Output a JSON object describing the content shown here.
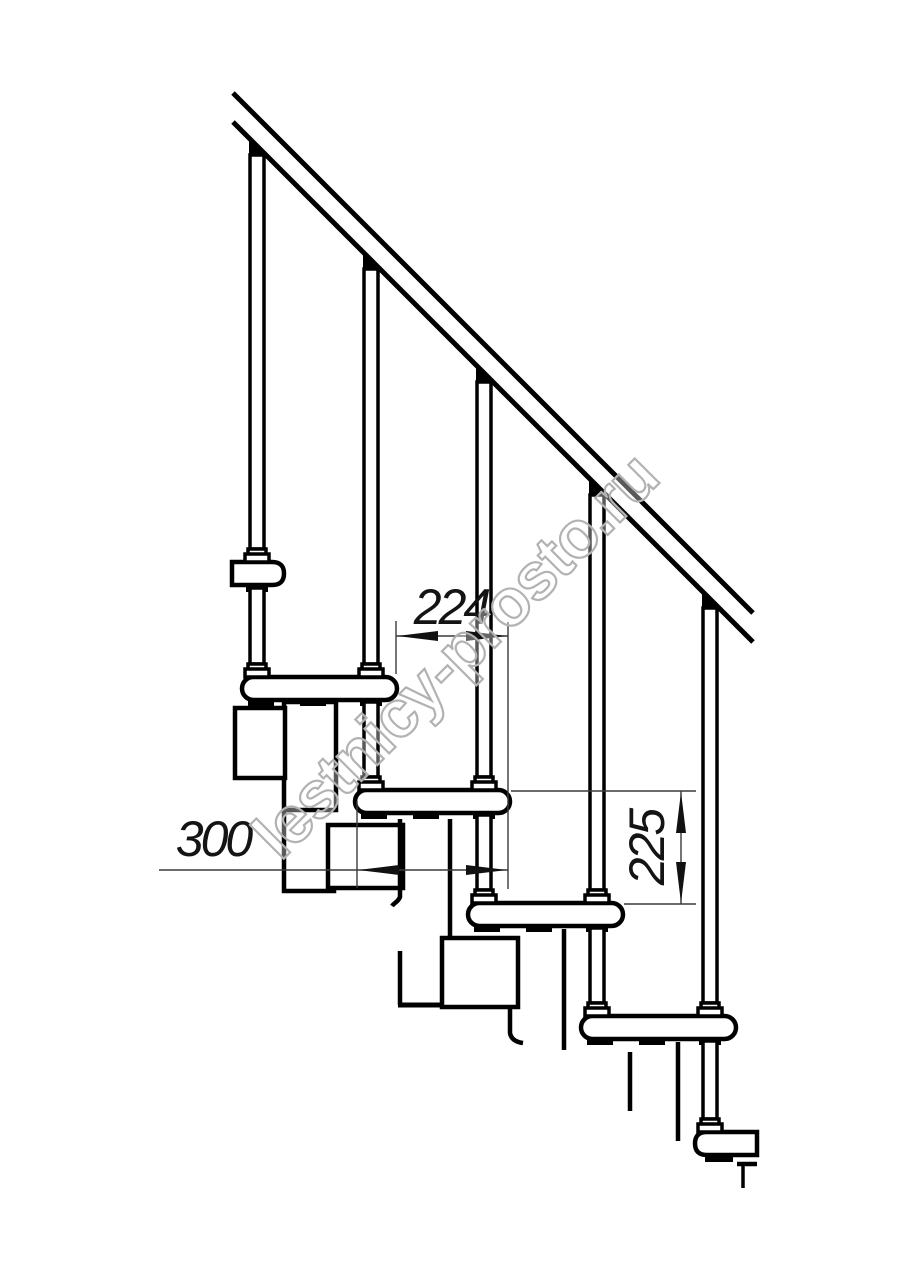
{
  "drawing": {
    "dimensions": [
      {
        "id": "step-run",
        "label": "224",
        "orientation": "horizontal"
      },
      {
        "id": "tread-depth",
        "label": "300",
        "orientation": "horizontal"
      },
      {
        "id": "rise-height",
        "label": "225",
        "orientation": "vertical"
      }
    ],
    "watermark": "lestnicy-prosto.ru",
    "colors": {
      "line": "#000000",
      "dimension_line": "#3a3a3a",
      "watermark_outline": "#b2b2b2",
      "background": "#ffffff"
    }
  }
}
